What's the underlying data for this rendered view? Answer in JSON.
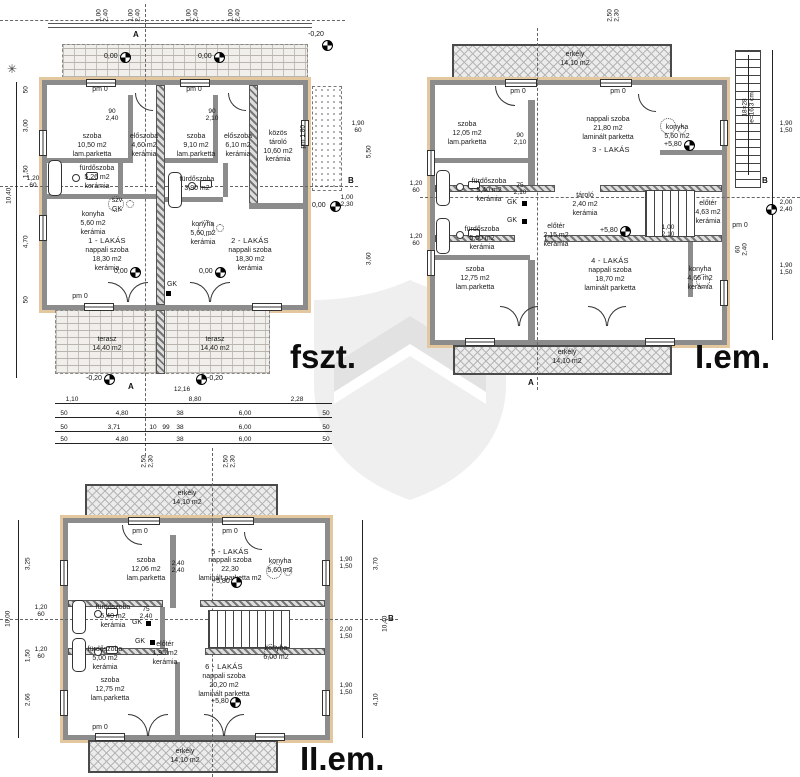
{
  "colors": {
    "wall": "#8c8c8c",
    "insulation": "#e3c79e",
    "watermark_shield": "#efefef",
    "watermark_chevron": "#e2e2e2"
  },
  "fszt": {
    "label": "fszt.",
    "apt1_title": "1 - LAKÁS",
    "apt1_living": "nappali szoba\n18,30 m2\nkerámia",
    "apt1_room": "szoba\n10,50 m2\nlam.parketta",
    "apt1_hall": "előszoba\n4,60 m2\nkerámia",
    "apt1_bath": "fürdőszoba\n5,26 m2\nkerámia",
    "apt1_kitchen": "konyha\n5,60 m2\nkerámia",
    "apt2_title": "2 - LAKÁS",
    "apt2_living": "nappali szoba\n18,30 m2\nkerámia",
    "apt2_room": "szoba\n9,10 m2\nlam.parketta",
    "apt2_hall": "előszoba\n6,10 m2\nkerámia",
    "apt2_bath": "fürdőszoba\n3,90 m2",
    "apt2_kitchen": "konyha\n5,60 m2\nkerámia",
    "storage": "közös\ntároló\n10,60 m2\nkerámia",
    "terrace": "terasz\n14,40 m2",
    "level_zero": "0,00",
    "level_minus": "-0,20",
    "szv_gk": "szv\nGK",
    "gk": "GK",
    "pm0": "pm 0",
    "pm180": "pm 1,80",
    "sec_a": "A",
    "sec_b": "B",
    "door_a": "90\n2,40",
    "door_b": "90\n2,10"
  },
  "iem": {
    "label": "I.em.",
    "balcony": "erkély\n14,10 m2",
    "apt3_title": "3 - LAKÁS",
    "apt3_living": "nappali szoba\n21,80 m2\nlaminált parketta",
    "apt3_room": "szoba\n12,05 m2\nlam.parketta",
    "apt3_bath": "fürdőszoba\n5,40 m2\nkerámia",
    "apt3_kitchen": "konyha\n5,60 m2",
    "apt4_title": "4 - LAKÁS",
    "apt4_living": "nappali szoba\n18,70 m2\nlaminált parketta",
    "apt4_room": "szoba\n12,75 m2\nlam.parketta",
    "apt4_bath": "fürdőszoba\n5,00 m2\nkerámia",
    "apt4_kitchen": "konyha\n4,66 m2\nkerámia",
    "hall_mid": "előtér\n2,15 m2\nkerámia",
    "hall_right": "előtér\n4,63 m2\nkerámia",
    "storage_mid": "tároló\n2,40 m2\nkerámia",
    "stair_note": "18×28\ne=16,3 cm",
    "level": "+5,80",
    "gk": "GK",
    "pm0": "pm 0",
    "sec_a": "A",
    "sec_b": "B",
    "door_a": "90\n2,10",
    "door_b": "75\n2,10",
    "door_c": "1,00\n2,10"
  },
  "iiem": {
    "label": "II.em.",
    "balcony": "erkély\n14,10 m2",
    "apt5_title": "5 - LAKÁS",
    "apt5_living": "nappali szoba\n22,30\nlaminált parketta m2",
    "apt5_room": "szoba\n12,06 m2\nlam.parketta",
    "apt5_bath": "fürdőszoba\n5,40 m2\nkerámia",
    "apt5_kitchen": "konyha\n5,60 m2",
    "apt6_title": "6 - LAKÁS",
    "apt6_living": "nappali szoba\n20,20 m2\nlaminált parketta",
    "apt6_room": "szoba\n12,75 m2\nlam.parketta",
    "apt6_bath": "fürdőszoba\n5,00 m2\nkerámia",
    "apt6_kitchen": "konyha\n6,00 m2",
    "hall": "előtér\n1,95 m2\nkerámia",
    "level": "+5,80",
    "gk": "GK",
    "pm0": "pm 0",
    "sec_b": "B",
    "door_a": "2,40\n2,40",
    "door_b": "75\n2,40"
  },
  "dims": {
    "fszt_top_pair": "1,00\n2,40",
    "fszt_left_a": "50",
    "fszt_left_b": "3,00",
    "fszt_left_c": "1,50",
    "fszt_left_d": "1,20\n60",
    "fszt_left_e": "4,70",
    "fszt_left_f": "50",
    "fszt_left_total": "10,40",
    "fszt_right_a": "1,90\n60",
    "fszt_right_b": "5,50",
    "fszt_right_c": "1,00\n2,30",
    "fszt_right_d": "3,60",
    "fszt_total": "12,16",
    "fszt_r1a": "1,10",
    "fszt_r1b": "8,80",
    "fszt_r1c": "2,28",
    "fszt_r2a": "50",
    "fszt_r2b": "4,80",
    "fszt_r2c": "38",
    "fszt_r2d": "6,00",
    "fszt_r2e": "50",
    "fszt_r3a": "50",
    "fszt_r3b": "3,71",
    "fszt_r3c": "10",
    "fszt_r3d": "99",
    "fszt_r3e": "38",
    "fszt_r3f": "6,00",
    "fszt_r3g": "50",
    "fszt_r4a": "50",
    "fszt_r4b": "4,80",
    "fszt_r4c": "38",
    "fszt_r4d": "6,00",
    "fszt_r4e": "50",
    "iem_top_pair": "2,50\n2,30",
    "iem_left_pair": "1,20\n60",
    "iem_right_a": "1,90\n1,50",
    "iem_right_b": "2,00\n2,40",
    "iem_right_c": "60\n2,40",
    "iem_right_d": "1,90\n1,50",
    "iiem_top_pair": "2,50\n2,30",
    "iiem_left_pair": "1,20\n60",
    "iiem_left_a": "3,25",
    "iiem_left_b": "1,50",
    "iiem_left_c": "2,66",
    "iiem_left_total": "10,00",
    "iiem_right_a": "1,90\n1,50",
    "iiem_right_b": "2,00\n1,50",
    "iiem_right_c": "1,90\n1,50",
    "iiem_right_v1": "3,70",
    "iiem_right_v2": "10,40",
    "iiem_right_v3": "4,10"
  }
}
